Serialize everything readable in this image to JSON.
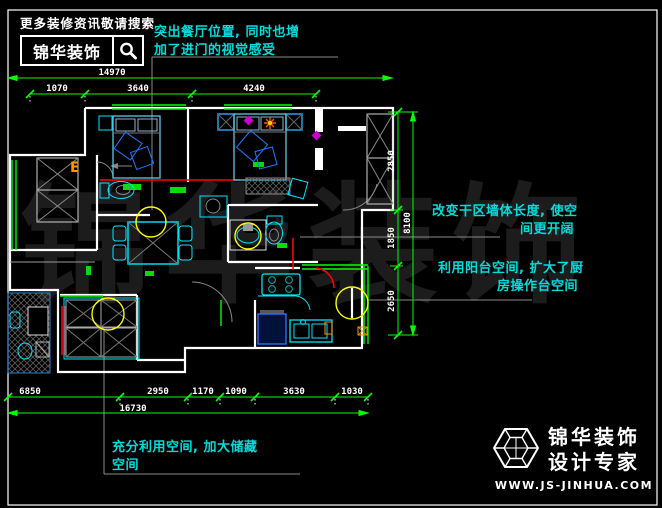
{
  "header": {
    "tagline": "更多装修资讯敬请搜索",
    "brand": "锦华装饰",
    "search_icon": "magnifier-icon"
  },
  "watermark": {
    "text": "锦华装饰",
    "color": "#1c1c1c"
  },
  "annotations": {
    "color": "#00dcdc",
    "dining": {
      "line1": "突出餐厅位置, 同时也增",
      "line2": "加了进门的视觉感受"
    },
    "dry_area": {
      "line1": "改变干区墙体长度, 使空",
      "line2": "间更开阔"
    },
    "balcony": {
      "line1": "利用阳台空间, 扩大了厨",
      "line2": "房操作台空间"
    },
    "storage": {
      "line1": "充分利用空间, 加大储藏",
      "line2": "空间"
    }
  },
  "dims": {
    "color": "#00ff00",
    "top": {
      "overall": "14970",
      "segments": [
        "1070",
        "3640",
        "4240"
      ]
    },
    "bottom": {
      "overall": "16730",
      "segments": [
        "6850",
        "2950",
        "1170",
        "1090",
        "3630",
        "1030"
      ]
    },
    "right": {
      "overall": "8100",
      "segments": [
        "2850",
        "1850",
        "2650"
      ]
    }
  },
  "plan": {
    "colors": {
      "walls": "#ffffff",
      "furniture": "#00e5ff",
      "windows": "#00ff00",
      "dimension_lines": "#00ff00",
      "highlight_circles": "#ffff00",
      "modified_walls": "#ff0000",
      "leader_lines": "#8a8a8a"
    },
    "electric_mark": "E"
  },
  "footer": {
    "brand_line1": "锦华装饰",
    "brand_line2": "设计专家",
    "website": "WWW.JS-JINHUA.COM",
    "icon": "cube-wireframe-icon"
  }
}
